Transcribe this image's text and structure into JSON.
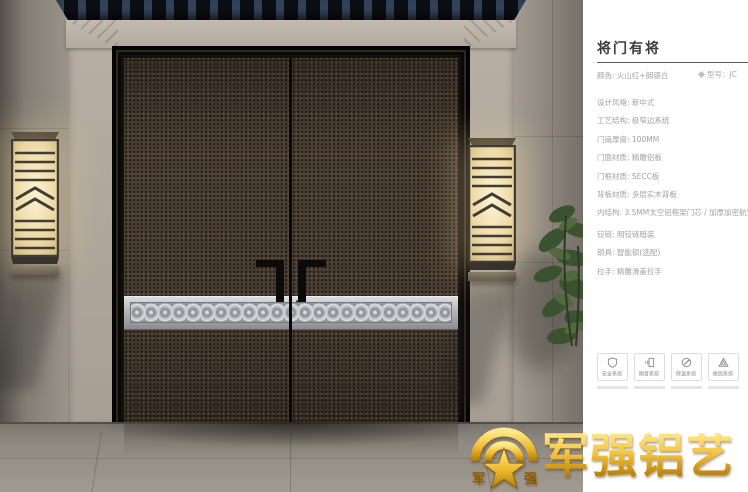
{
  "panel": {
    "title": "将门有将",
    "color_label": "颜色: 火山红+朗银白",
    "model_label": "型号：JC",
    "specs": [
      "设计风格: 新中式",
      "工艺结构: 极窄边系统",
      "门扇厚度: 100MM",
      "门面材质: 精雕铝板",
      "门框材质: SECC板",
      "背板材质: 多层实木背板",
      "内结构: 3.5MM太空铝框架门芯 / 加厚加密航空铝蜂窝芯",
      "铰链: 明铰链暗装",
      "锁具: 智能锁(选配)",
      "拉手: 精雕滑盖拉手"
    ],
    "features": [
      {
        "label": "安全系统",
        "icon": "shield-icon"
      },
      {
        "label": "隔音系统",
        "icon": "soundproof-icon"
      },
      {
        "label": "保温系统",
        "icon": "insulation-icon"
      },
      {
        "label": "稳固系统",
        "icon": "stability-icon"
      }
    ]
  },
  "brand": {
    "name": "军强铝艺",
    "emblem_left": "军",
    "emblem_right": "强"
  },
  "colors": {
    "gold": "#e8b32a",
    "title_text": "#3d3d3d",
    "spec_text": "#a2a2a2",
    "door_leaf": "#4a3e33",
    "silver_band": "#b3b4b8",
    "lantern_glow": "#f0e2bb"
  }
}
